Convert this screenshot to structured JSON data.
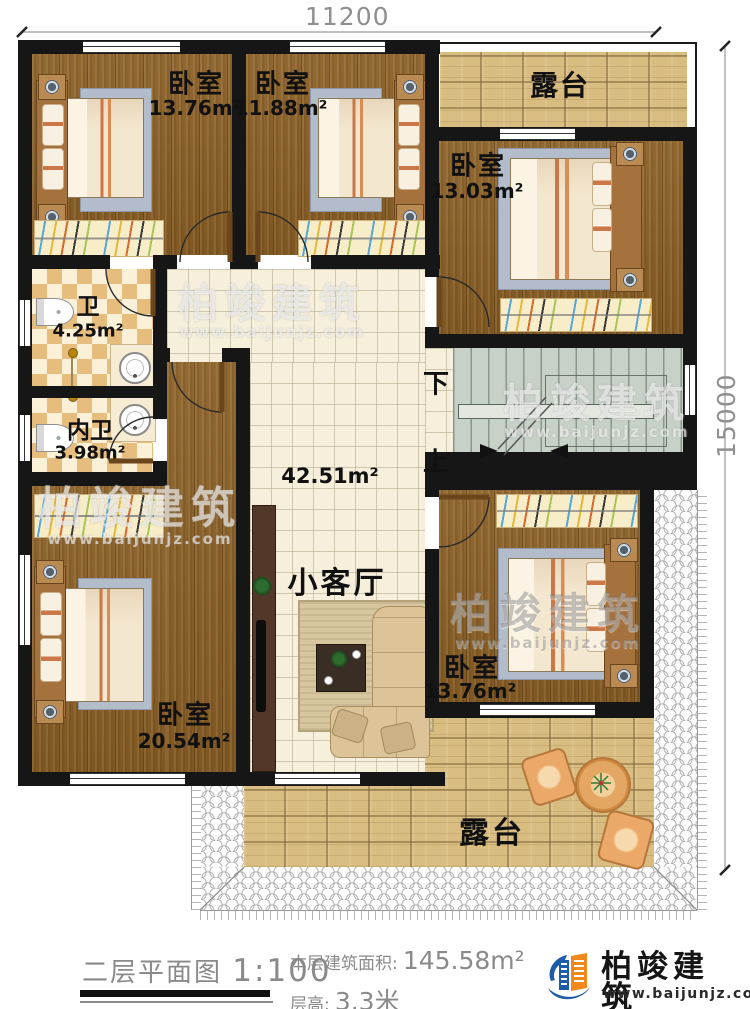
{
  "dimensions": {
    "top": "11200",
    "right": "15000"
  },
  "watermark": {
    "brand": "柏竣建筑",
    "url": "www.baijunjz.com"
  },
  "rooms": {
    "bedroom_top_left": {
      "name": "卧室",
      "area": "13.76m²"
    },
    "bedroom_top_middle": {
      "name": "卧室",
      "area": "11.88m²"
    },
    "bedroom_right": {
      "name": "卧室",
      "area": "13.03m²"
    },
    "bedroom_bottom_left": {
      "name": "卧室",
      "area": "20.54m²"
    },
    "bedroom_bottom_right": {
      "name": "卧室",
      "area": "13.76m²"
    },
    "bathroom": {
      "name": "卫",
      "area": "4.25m²"
    },
    "inner_bathroom": {
      "name": "内卫",
      "area": "3.98m²"
    },
    "living_room": {
      "name": "小客厅",
      "area": "42.51m²"
    },
    "terrace_top": {
      "name": "露台"
    },
    "terrace_bottom": {
      "name": "露台"
    },
    "stairs": {
      "down_label": "下",
      "up_label": "上"
    }
  },
  "footer": {
    "plan_name": "二层平面图",
    "plan_scale": "1:100",
    "floor_area_label": "本层建筑面积:",
    "floor_area_value": "145.58m²",
    "floor_height_label": "层高:",
    "floor_height_value": "3.3米",
    "brand_name": "柏竣建筑",
    "brand_url": "www.baijunjz.com"
  },
  "colors": {
    "wall": "#161616",
    "wood_floor": "#8b5f24",
    "hall_tile": "#f5efdc",
    "bath_tile": "#e7bd7e",
    "paving": "#d9bc80",
    "stairs": "#c8d1c7",
    "logo_blue": "#1c5ca8",
    "logo_orange": "#f0881c",
    "dim_text": "#8f8f8f"
  }
}
